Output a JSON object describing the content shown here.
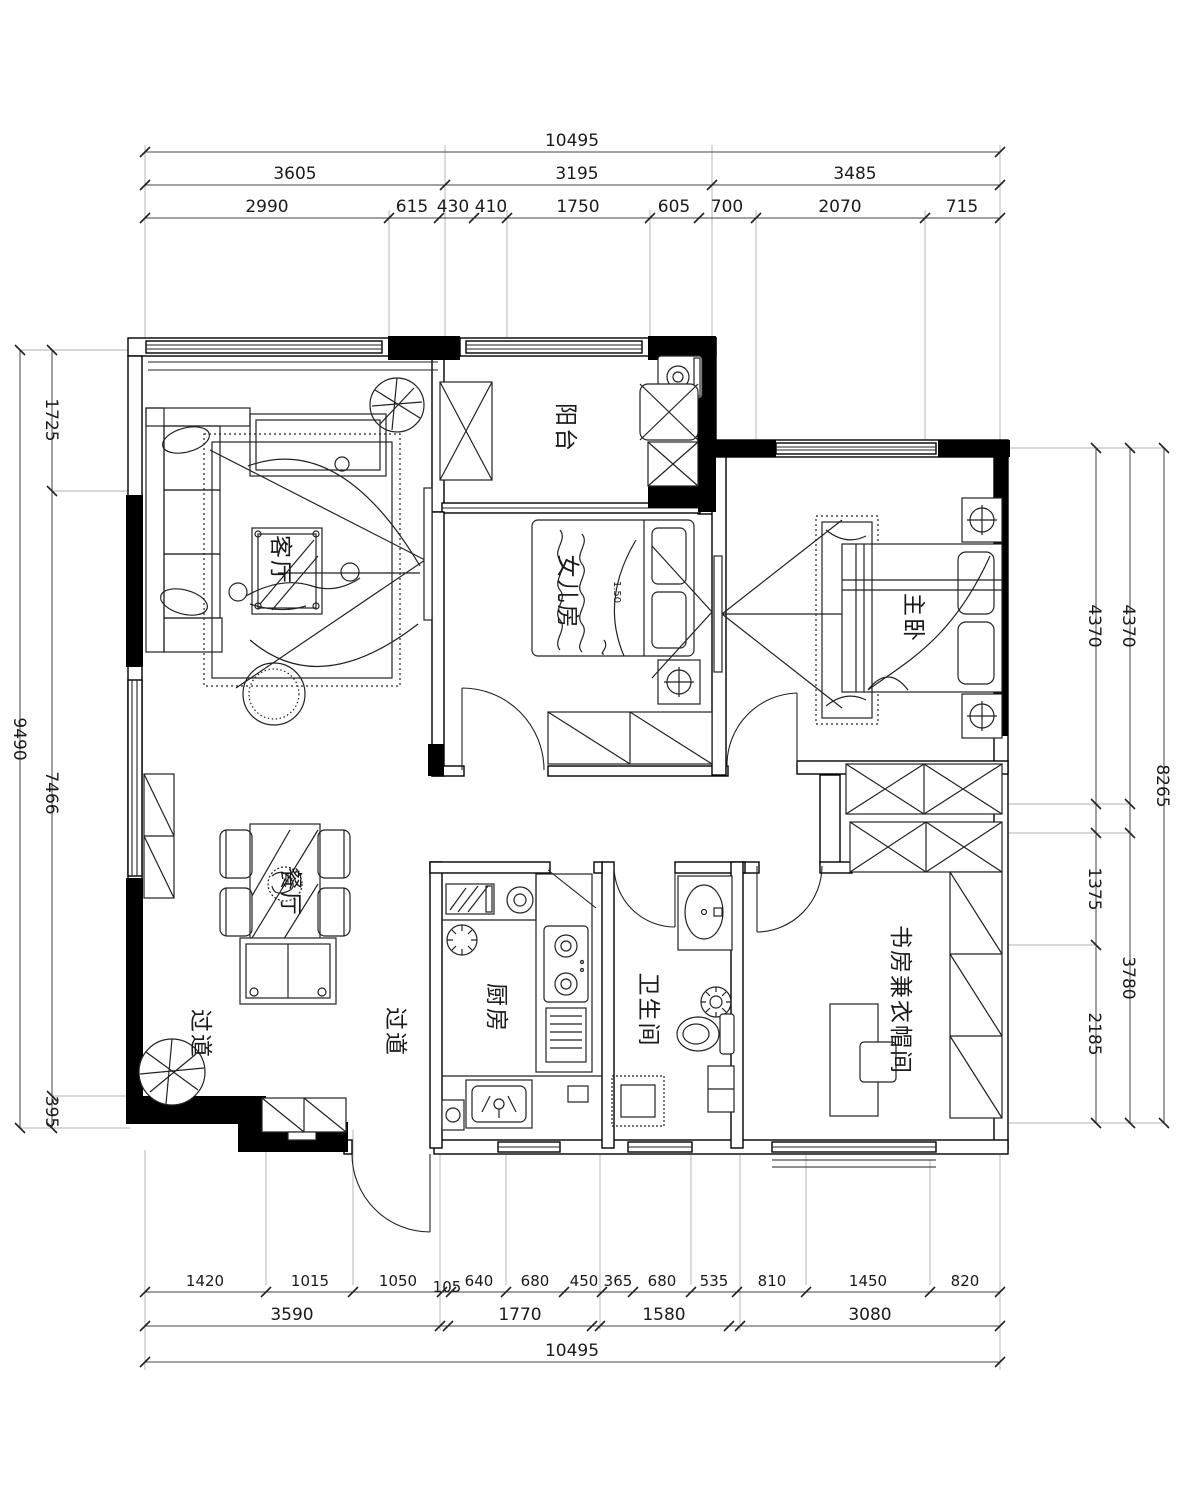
{
  "rooms": {
    "living": "客厅",
    "balcony": "阳台",
    "daughter": "女儿房",
    "master": "主卧",
    "dining": "餐厅",
    "kitchen": "厨房",
    "bath": "卫生间",
    "study": "书房兼衣帽间",
    "hall_left": "过道",
    "hall_right": "过道",
    "bed_size": "1.50"
  },
  "dims": {
    "top": {
      "total": "10495",
      "row2": [
        "3605",
        "3195",
        "3485"
      ],
      "row3": [
        "2990",
        "615",
        "430",
        "410",
        "1750",
        "605",
        "700",
        "2070",
        "715"
      ]
    },
    "bottom": {
      "row1": [
        "1420",
        "1015",
        "1050",
        "105",
        "640",
        "680",
        "450",
        "365",
        "680",
        "535",
        "810",
        "1450",
        "820"
      ],
      "row2": [
        "3590",
        "1770",
        "1580",
        "3080"
      ],
      "total": "10495"
    },
    "left": {
      "outer": "9490",
      "inner": [
        "1725",
        "7466",
        "395"
      ]
    },
    "right": {
      "inner": [
        "4370",
        "1375",
        "2185"
      ],
      "middle": [
        "4370",
        "3780"
      ],
      "outer": "8265"
    }
  },
  "colors": {
    "ink": "#1a1a1a",
    "wall": "#000000",
    "background": "#ffffff"
  }
}
